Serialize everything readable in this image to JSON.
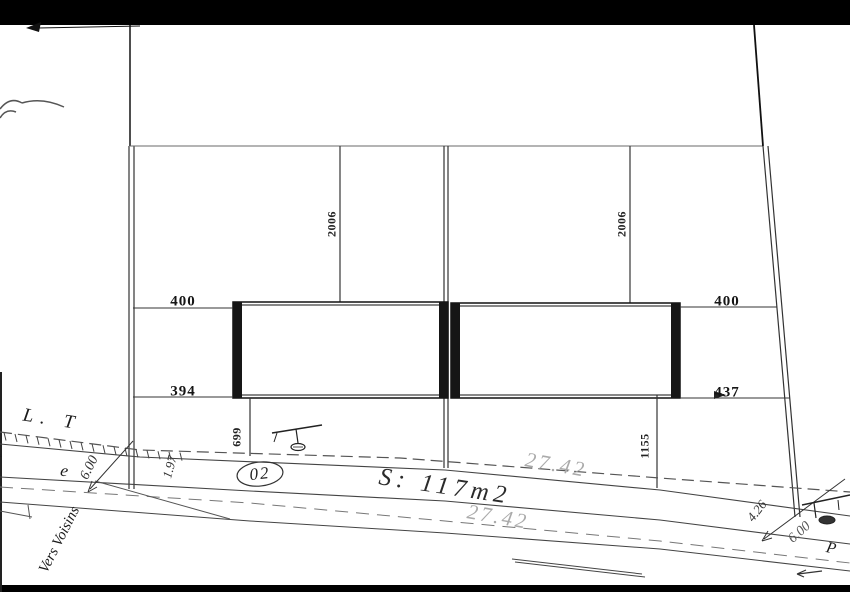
{
  "drawing": {
    "parcel": {
      "lot_number": "02",
      "area": "S: 117m2",
      "frontage_top": "27.42",
      "frontage_bottom": "27.42"
    },
    "dimensions": {
      "left_top": "400",
      "left_bottom": "394",
      "right_top": "400",
      "right_bottom": "437",
      "depth_left": "2006",
      "depth_right": "2006",
      "setback_left": "699",
      "setback_right": "1155",
      "road_width_left": "6.00",
      "road_width_right": "6.00",
      "edge_left": "1.97",
      "edge_right": "4.26"
    },
    "labels": {
      "boundary": "L. T",
      "street_fragment": "t   e",
      "direction": "Vers Voisins",
      "pole": "P"
    }
  },
  "colors": {
    "paper": "#ffffff",
    "ink": "#1a1a1a",
    "line": "#444444",
    "faint_dim": "#aaaaaa",
    "frame_bar": "#000000"
  }
}
